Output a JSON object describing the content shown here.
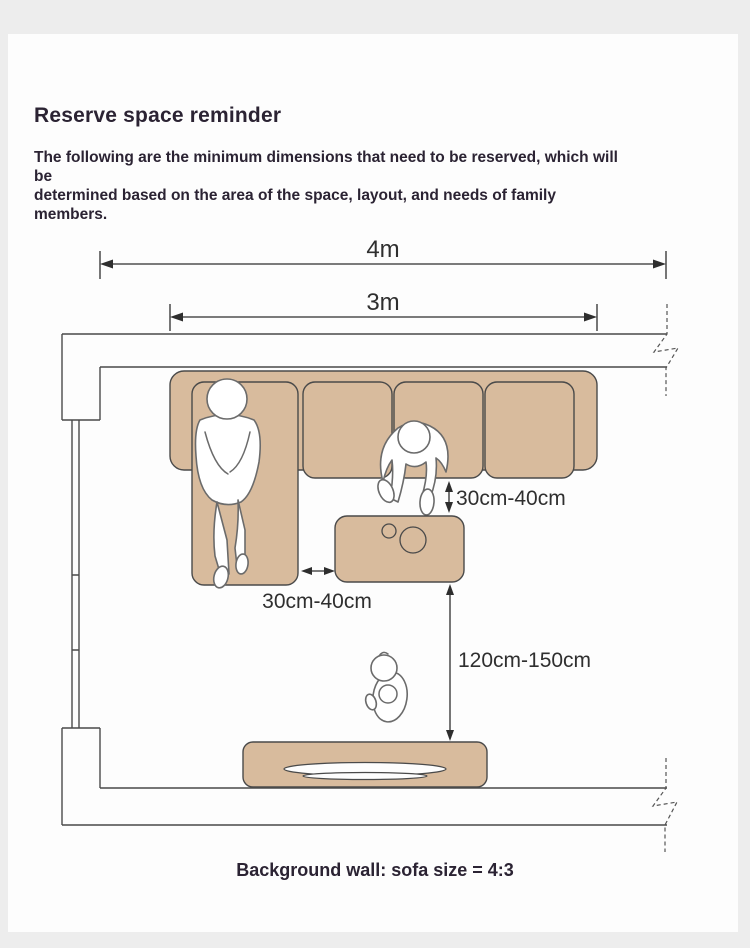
{
  "header": {
    "title": "Reserve space reminder",
    "subtitle_line1": "The following are the minimum dimensions that need to be reserved, which will be",
    "subtitle_line2": "determined based on the area of the space, layout, and needs of family members."
  },
  "diagram": {
    "dim_total_width": "4m",
    "dim_sofa_width": "3m",
    "dim_side_gap": "30cm-40cm",
    "dim_front_gap": "30cm-40cm",
    "dim_walkway": "120cm-150cm"
  },
  "footer": {
    "caption": "Background wall: sofa size = 4:3"
  },
  "colors": {
    "page_background": "#ededed",
    "card_background": "#fdfdfd",
    "furniture_fill": "#d8bb9d",
    "line_color": "#4a4a4a",
    "text_dark": "#2b2333",
    "dimension_text": "#2f2f2f"
  }
}
